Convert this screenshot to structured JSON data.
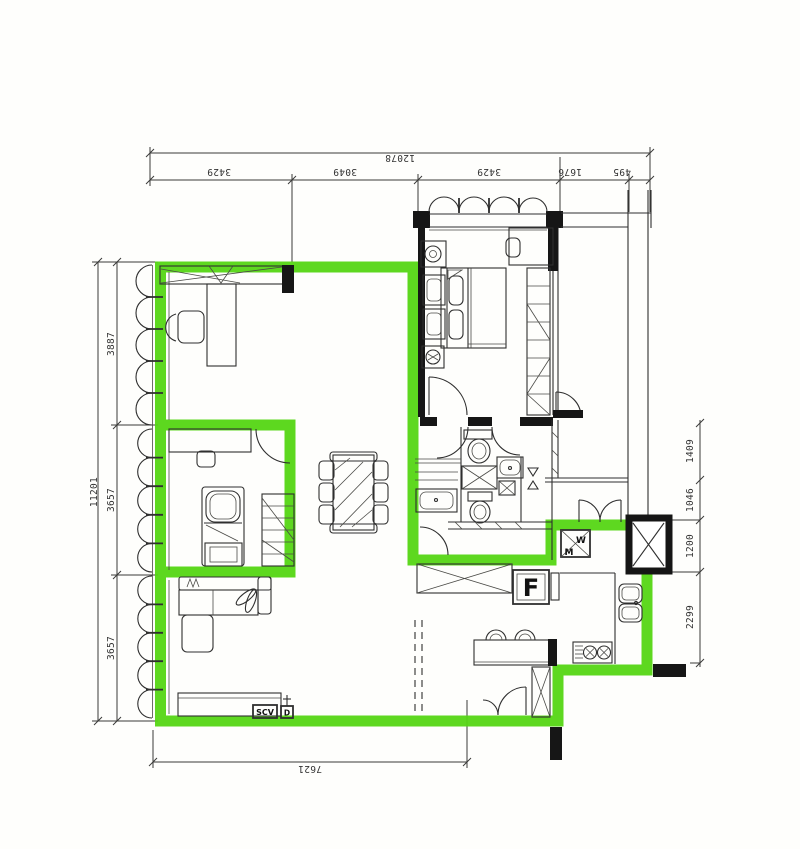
{
  "dimensions": {
    "top": {
      "total": "12078",
      "segments": [
        "3429",
        "3049",
        "3429",
        "1676",
        "495"
      ]
    },
    "left": {
      "total": "11201",
      "segments": [
        "3887",
        "3657",
        "3657"
      ]
    },
    "right": {
      "segments": [
        "1409",
        "1046",
        "1200",
        "2299"
      ]
    },
    "bottom": {
      "total": "7621"
    }
  },
  "labels": {
    "fridge": "F",
    "washer_w": "W",
    "washer_m": "M",
    "tv_box": "SCV",
    "outlet": "D"
  },
  "colors": {
    "highlight_green": "#55d614",
    "ink": "#2f2f2f"
  }
}
